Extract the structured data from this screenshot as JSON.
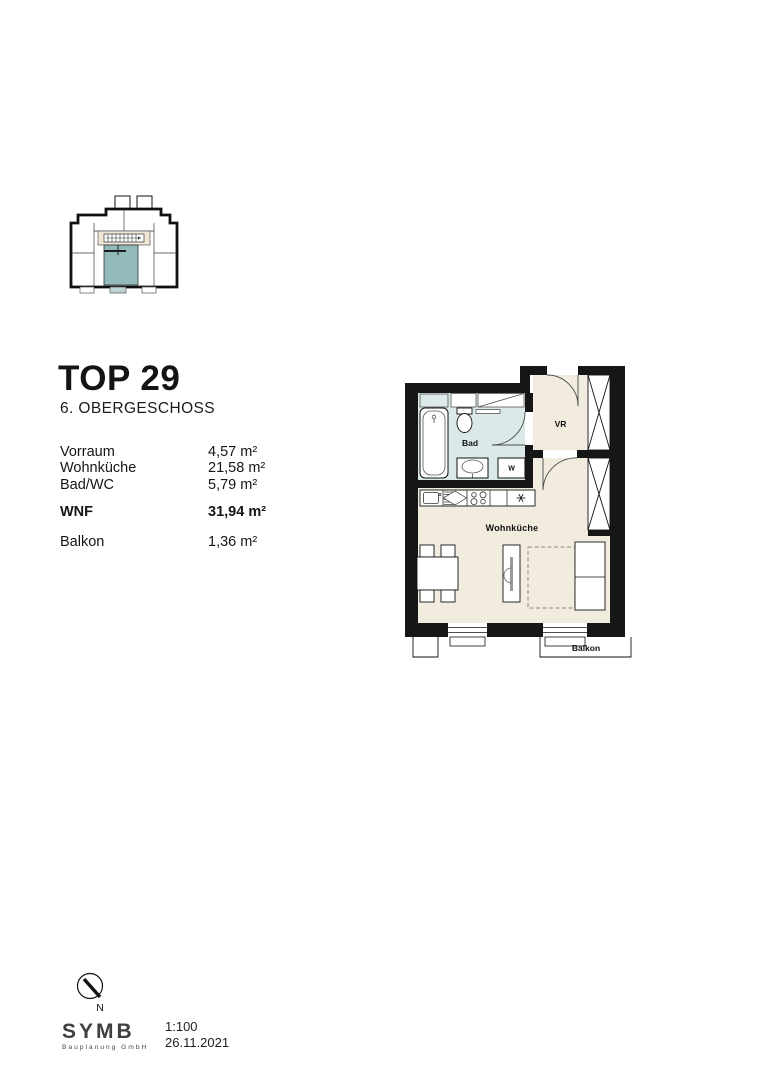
{
  "title_block": {
    "unit": "TOP 29",
    "floor": "6. OBERGESCHOSS"
  },
  "area_table": {
    "rows": [
      {
        "label": "Vorraum",
        "value": "4,57 m²"
      },
      {
        "label": "Wohnküche",
        "value": "21,58 m²"
      },
      {
        "label": "Bad/WC",
        "value": "5,79 m²"
      }
    ],
    "total": {
      "label": "WNF",
      "value": "31,94 m²"
    },
    "balcony": {
      "label": "Balkon",
      "value": "1,36 m²"
    }
  },
  "plan": {
    "labels": {
      "bad": "Bad",
      "vr": "VR",
      "wohnkueche": "Wohnküche",
      "balkon": "Balkon",
      "washer": "W"
    },
    "icons": {
      "fridge_symbol": "asterisk-6-spoke",
      "wardrobe_symbol": "crossed-box",
      "stair_symbol": "stair-run-with-arrow"
    }
  },
  "footer": {
    "north": "N",
    "logo": "SYMB",
    "logo_sub": "Bauplanung GmbH",
    "scale": "1:100",
    "date": "26.11.2021"
  },
  "colors": {
    "wall": "#161616",
    "bath_floor": "#dce9e9",
    "living_floor": "#f2ecdf",
    "corridor": "#efe7d4",
    "highlight": "#93bbbc",
    "highlight_light": "#bdd6d5",
    "line": "#111111"
  }
}
